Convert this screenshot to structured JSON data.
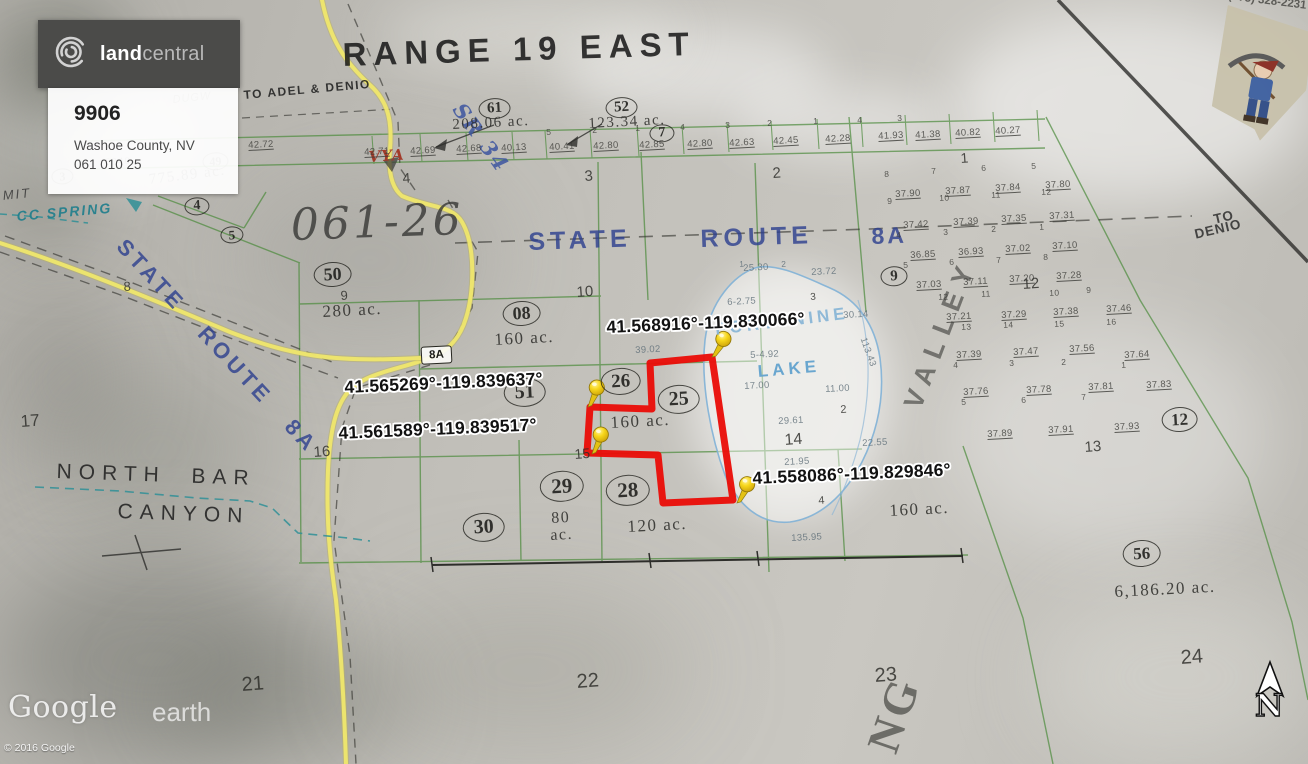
{
  "header": {
    "logo_land": "land",
    "logo_central": "central",
    "listing_id": "9906",
    "location": "Washoe County, NV",
    "apn": "061 010 25"
  },
  "watermark": {
    "google": "Google",
    "earth": "earth",
    "copyright": "© 2016 Google"
  },
  "contact": {
    "phone": "(775) 328-2231"
  },
  "compass": {
    "north": "N"
  },
  "route_shield": "8A",
  "pins": [
    "41.568916°-119.830066°",
    "41.565269°-119.839637°",
    "41.561589°-119.839517°",
    "41.558086°-119.829846°"
  ],
  "map_labels": {
    "major": [
      "RANGE 19 EAST",
      "TO ADEL & DENIO",
      "SR 34",
      "061-26",
      "STATE",
      "ROUTE",
      "8A",
      "STATE   ROUTE   8A",
      "TO",
      "DENIO",
      "CC SPRING",
      "MIT",
      "NORTH  BAR",
      "CANYON",
      "FORTYNINE",
      "LAKE",
      "VALLEY",
      "NG",
      "VYA",
      "DUGW"
    ],
    "circled": [
      "61",
      "52",
      "7",
      "4",
      "5",
      "50",
      "08",
      "26",
      "51",
      "25",
      "29",
      "28",
      "30",
      "9",
      "12",
      "56",
      "49",
      "3"
    ],
    "acreage": [
      "208.06 ac.",
      "123.34 ac.",
      "775.89 ac.",
      "280 ac.",
      "160 ac.",
      "160 ac.",
      "80\nac.",
      "120 ac.",
      "160 ac.",
      "6,186.20 ac.",
      "6240"
    ],
    "sections": [
      "3",
      "2",
      "4",
      "1",
      "10",
      "9",
      "8",
      "17",
      "16",
      "15",
      "14",
      "13",
      "12",
      "21",
      "22",
      "23",
      "24",
      "2",
      "4",
      "3"
    ],
    "survey": [
      "42.72",
      "42.71",
      "42.69",
      "42.68",
      "40.13",
      "40.41",
      "42.80",
      "42.85",
      "42.80",
      "42.63",
      "42.45",
      "42.28",
      "41.93",
      "41.38",
      "40.82",
      "40.27",
      "5",
      "2",
      "1",
      "4",
      "3",
      "2",
      "1",
      "4",
      "3",
      "8",
      "7",
      "6",
      "5",
      "37.90",
      "37.87",
      "37.84",
      "37.80",
      "9",
      "10",
      "11",
      "12",
      "37.42",
      "37.39",
      "37.35",
      "37.31",
      "4",
      "3",
      "2",
      "1",
      "36.85",
      "36.93",
      "37.02",
      "37.10",
      "5",
      "6",
      "7",
      "8",
      "37.03",
      "37.11",
      "37.20",
      "37.28",
      "12",
      "11",
      "10",
      "9",
      "37.21",
      "37.29",
      "37.38",
      "37.46",
      "13",
      "14",
      "15",
      "16",
      "37.39",
      "37.47",
      "37.56",
      "37.64",
      "4",
      "3",
      "2",
      "1",
      "37.76",
      "37.78",
      "37.81",
      "37.83",
      "5",
      "6",
      "7",
      "37.89",
      "37.91",
      "37.93",
      "25.30",
      "23.72",
      "2",
      "1",
      "6-2.75",
      "30.14",
      "5-4.92",
      "17.00",
      "11.00",
      "29.61",
      "39.02",
      "22.55",
      "135.95",
      "21.95",
      "113.43"
    ]
  }
}
